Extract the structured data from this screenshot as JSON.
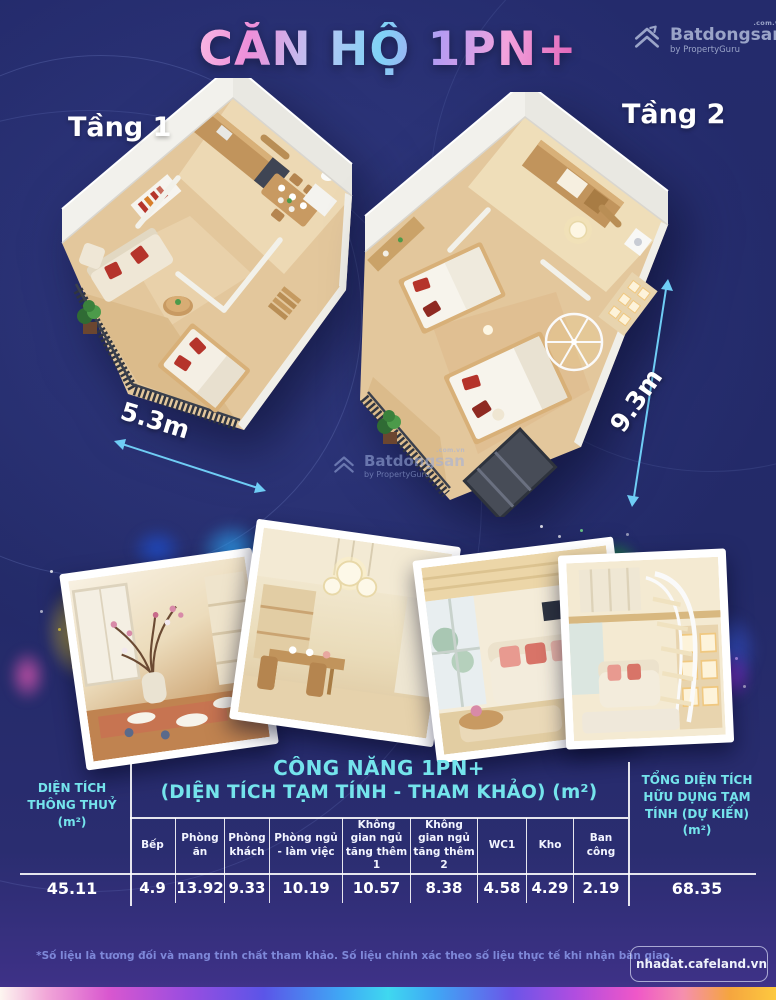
{
  "header": {
    "title": "CĂN HỘ 1PN+"
  },
  "brand": {
    "name": "Batdongsan",
    "domain": ".com.vn",
    "byline": "by PropertyGuru"
  },
  "floorplans": {
    "floor1": {
      "label": "Tầng 1",
      "width_dim": "5.3m"
    },
    "floor2": {
      "label": "Tầng 2",
      "depth_dim": "9.3m"
    }
  },
  "table": {
    "group_title_line1": "CÔNG NĂNG 1PN+",
    "group_title_line2": "(DIỆN TÍCH TẠM TÍNH - THAM KHẢO)  (m²)",
    "clear_area": {
      "label": "DIỆN TÍCH THÔNG THUỶ (m²)",
      "value": "45.11"
    },
    "columns": [
      {
        "label": "Bếp",
        "value": "4.9"
      },
      {
        "label": "Phòng ăn",
        "value": "13.92"
      },
      {
        "label": "Phòng khách",
        "value": "9.33"
      },
      {
        "label": "Phòng ngủ - làm việc",
        "value": "10.19"
      },
      {
        "label": "Không gian ngủ tăng thêm 1",
        "value": "10.57"
      },
      {
        "label": "Không gian ngủ tăng thêm 2",
        "value": "8.38"
      },
      {
        "label": "WC1",
        "value": "4.58"
      },
      {
        "label": "Kho",
        "value": "4.29"
      },
      {
        "label": "Ban công",
        "value": "2.19"
      }
    ],
    "total": {
      "label": "TỔNG DIỆN TÍCH HỮU DỤNG TẠM TÍNH (DỰ KIẾN) (m²)",
      "value": "68.35"
    }
  },
  "footnote": "*Số liệu là tương đối và mang tính chất tham khảo. Số liệu chính xác theo số liệu thực tế khi nhận bàn giao.",
  "footer_badge": {
    "label": "nhadat.cafeland.vn"
  },
  "colors": {
    "accent_cyan": "#74e4ec",
    "arrow_blue": "#6fcdf5",
    "background": "#232a6a"
  }
}
